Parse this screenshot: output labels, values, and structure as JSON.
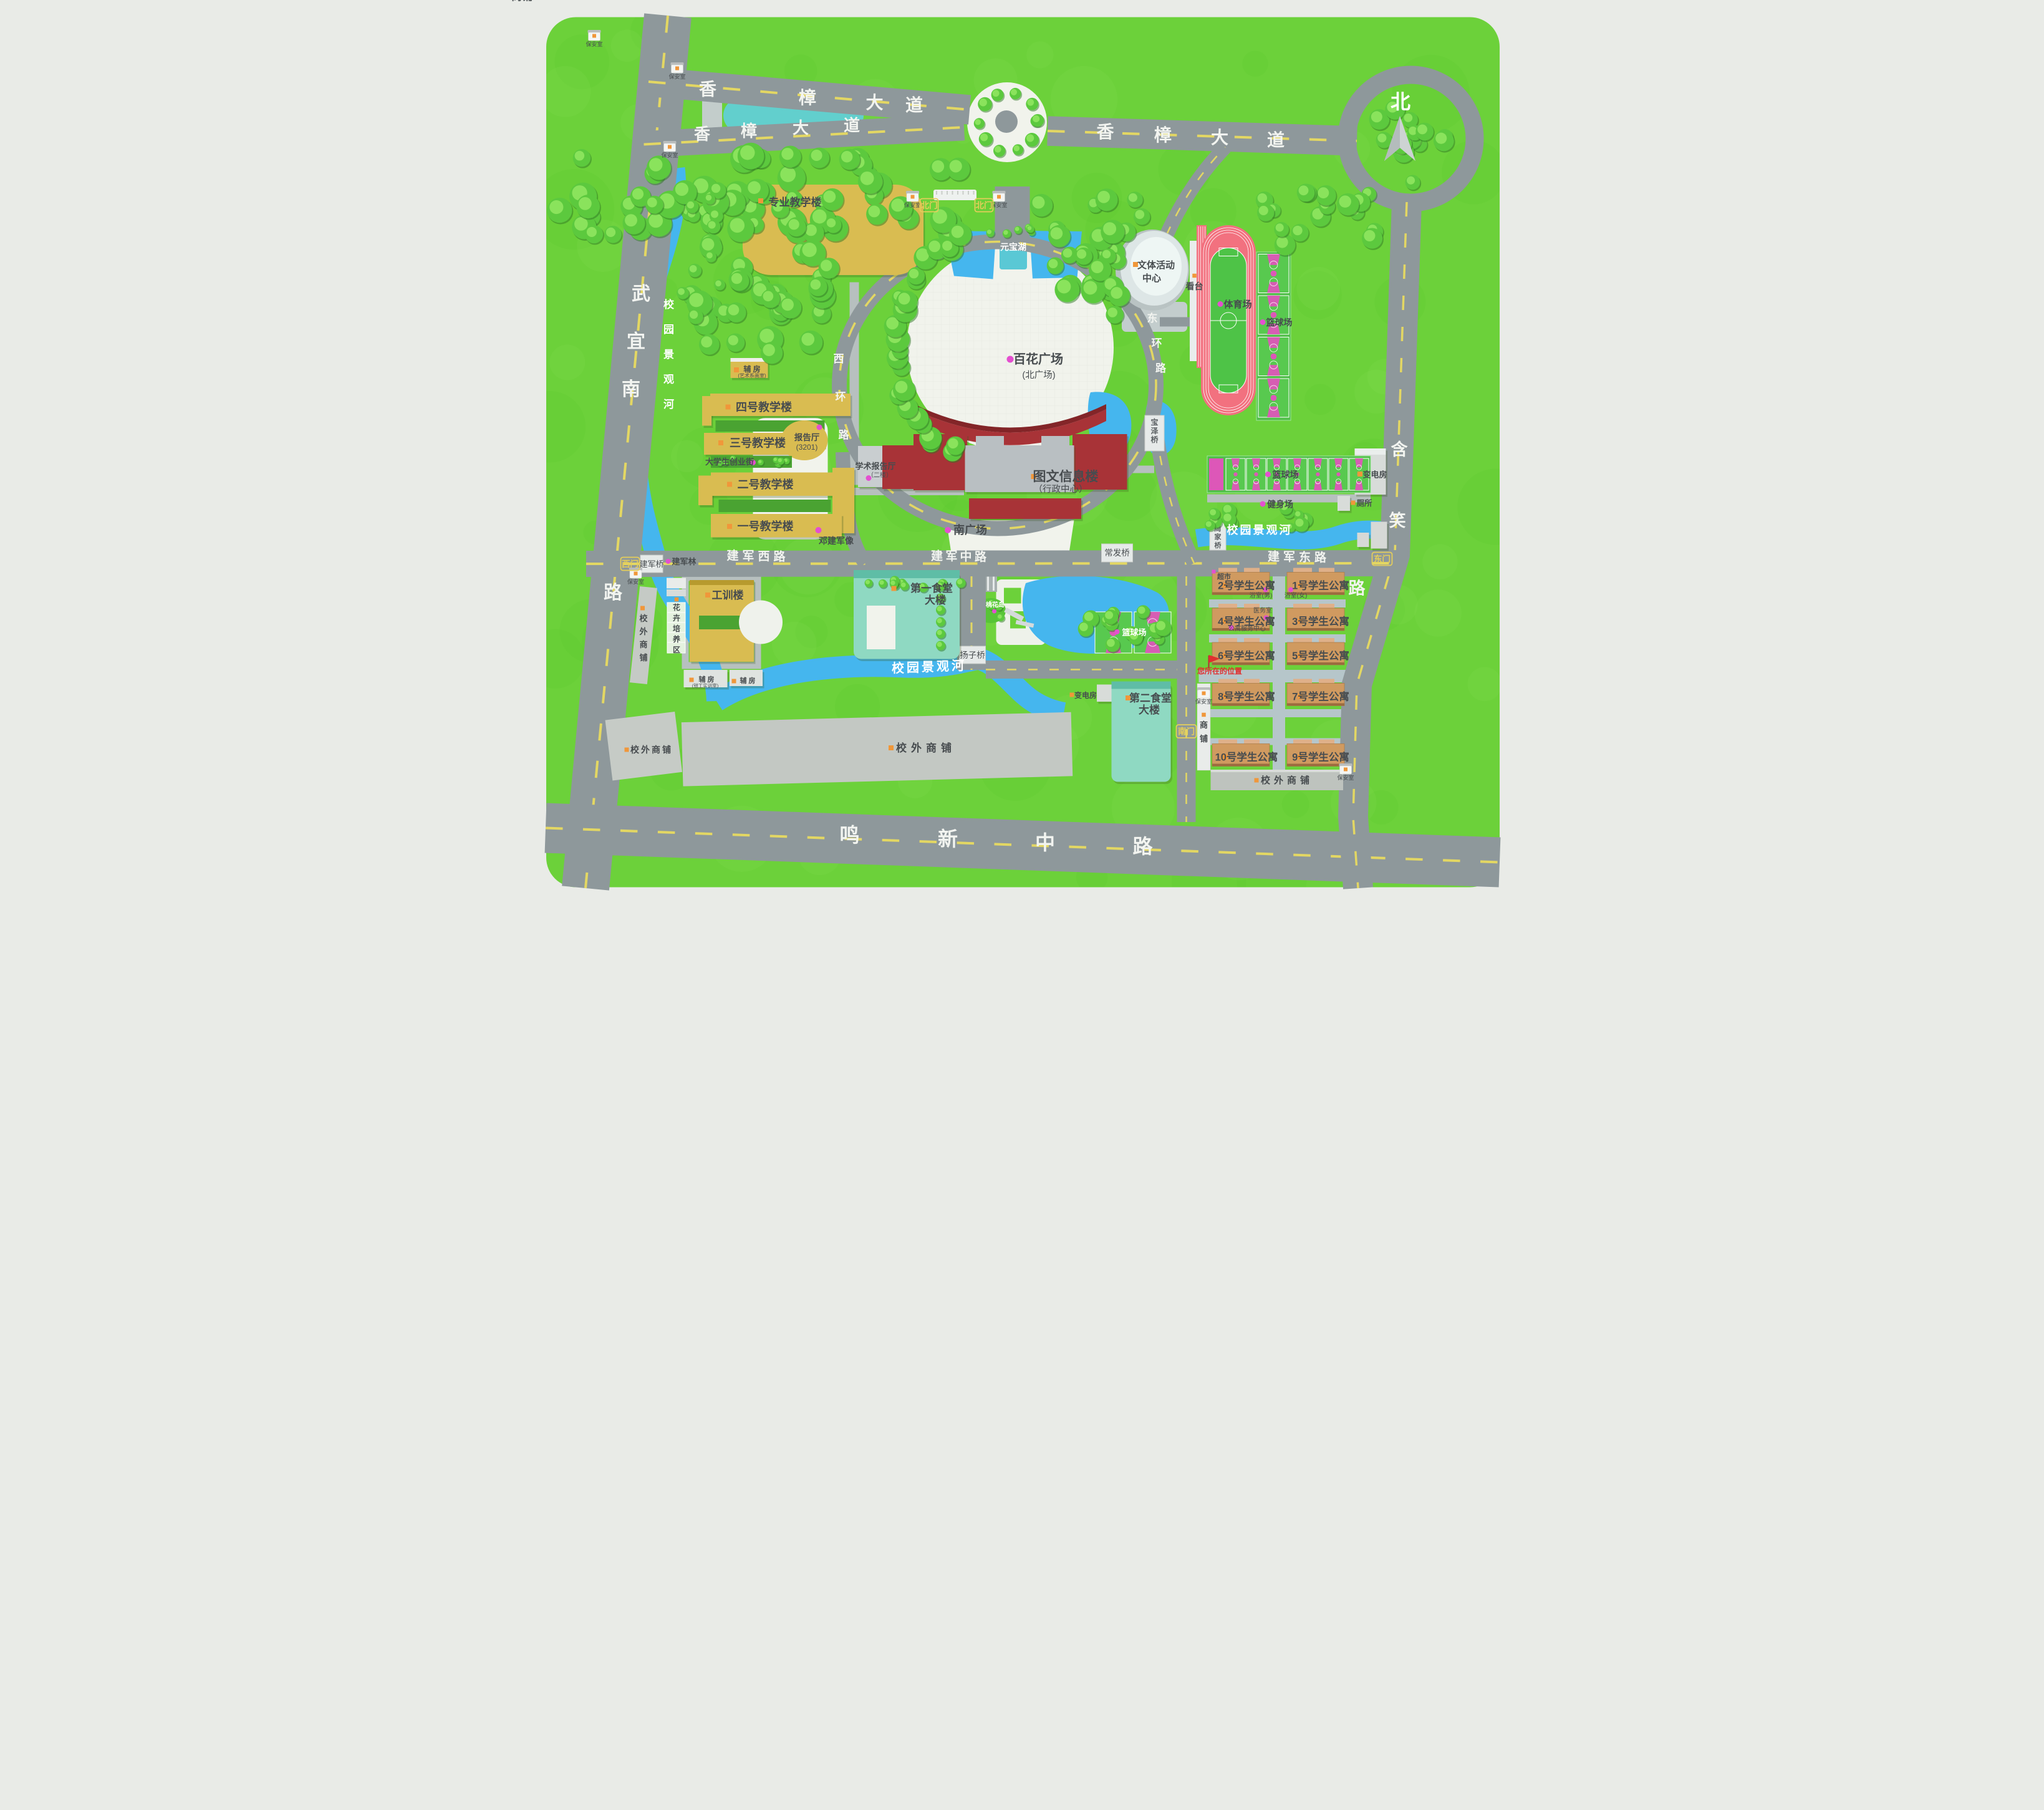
{
  "map": {
    "north_label": "北",
    "roads": {
      "xiangzhang_upper": "香樟大道",
      "xiangzhang_lower": "香樟大道",
      "xiangzhang_right": "香樟大道",
      "wuyi_south": "武宜南路",
      "mingxin": "鸣新中路",
      "hanxiao": "含笑路",
      "jianjun_west": "建军西路",
      "jianjun_middle": "建军中路",
      "jianjun_east": "建军东路",
      "xihuan": "西环路",
      "donghuan": "东环路"
    },
    "gates": {
      "north1": "北门",
      "north2": "北门",
      "west": "西门",
      "east": "东门",
      "south": "南门"
    },
    "bridges": {
      "jianjun": "建军桥",
      "changfa": "常发桥",
      "zhoujia": "周家桥",
      "baoze": "宝泽桥",
      "yangzi": "扬子桥"
    },
    "water": {
      "yuanbao": "元宝湖",
      "river_west": "校园景观河",
      "river_south": "校园景观河",
      "river_east": "校园景观河",
      "taohua_island": "桃花岛"
    },
    "places": {
      "prof_teaching": {
        "label": "专业教学楼"
      },
      "teach4": {
        "label": "四号教学楼"
      },
      "teach3": {
        "label": "三号教学楼"
      },
      "lecture_hall": {
        "label": "报告厅",
        "sub": "(3201)"
      },
      "startup_street": {
        "label": "大学生创业街"
      },
      "teach2": {
        "label": "二号教学楼"
      },
      "teach1": {
        "label": "一号教学楼"
      },
      "fufang_art": {
        "label": "辅 房",
        "sub": "(艺术系画室)"
      },
      "library": {
        "label": "图文信息楼",
        "sub": "（行政中心）"
      },
      "academic_hall": {
        "label": "学术报告厅",
        "sub": "（二楼）"
      },
      "baihua_square": {
        "label": "百花广场",
        "sub": "(北广场)"
      },
      "south_square": {
        "label": "南广场"
      },
      "deng_statue": {
        "label": "邓建军像"
      },
      "jianjun_grove": {
        "label": "建军林"
      },
      "activity_center": {
        "label": "文体活动",
        "label2": "中心"
      },
      "grandstand": {
        "label": "看台"
      },
      "stadium": {
        "label": "体育场"
      },
      "bball_ne": {
        "label": "篮球场"
      },
      "bball_mid": {
        "label": "篮球场"
      },
      "bball_se": {
        "label": "篮球场"
      },
      "fitness": {
        "label": "健身场"
      },
      "substation_ne": {
        "label": "变电房"
      },
      "toilet": {
        "label": "厕所"
      },
      "training_bldg": {
        "label": "工训楼"
      },
      "flower_zone": {
        "label": "花卉培养区"
      },
      "shops_west": {
        "label": "校外商铺"
      },
      "shops_bottom_left": {
        "label": "校外商铺"
      },
      "shops_bottom_center": {
        "label": "校外商铺"
      },
      "shops_se": {
        "label": "校外商铺"
      },
      "fufang_fitter": {
        "label": "辅 房",
        "sub": "(钳工实训室)"
      },
      "fufang2": {
        "label": "辅 房"
      },
      "canteen1": {
        "label": "第一食堂",
        "label2": "大楼"
      },
      "canteen2": {
        "label": "第二食堂",
        "label2": "大楼"
      },
      "substation_s": {
        "label": "变电房"
      },
      "supermarket": {
        "label": "超市"
      },
      "bath_male": {
        "label": "浴室(男)"
      },
      "bath_female": {
        "label": "浴室(女)"
      },
      "clinic": {
        "label": "医务室"
      },
      "apt_service": {
        "label": "公寓服务中心"
      },
      "shop_strip": {
        "label": "商铺"
      },
      "apt1": {
        "label": "1号学生公寓"
      },
      "apt2": {
        "label": "2号学生公寓"
      },
      "apt3": {
        "label": "3号学生公寓"
      },
      "apt4": {
        "label": "4号学生公寓"
      },
      "apt5": {
        "label": "5号学生公寓"
      },
      "apt6": {
        "label": "6号学生公寓"
      },
      "apt7": {
        "label": "7号学生公寓"
      },
      "apt8": {
        "label": "8号学生公寓"
      },
      "apt9": {
        "label": "9号学生公寓"
      },
      "apt10": {
        "label": "10号学生公寓"
      }
    },
    "you_are_here": "您所在的位置",
    "security_room": "保安室",
    "colors": {
      "page_bg": "#e9ebe7",
      "grass": "#6cd13a",
      "road": "#8e989b",
      "road_dash": "#e3d763",
      "road_text": "#f2f4f0",
      "minor_path": "#b7c0bf",
      "plaza": "#f1f3ec",
      "water": "#45b6ee",
      "pond_teal": "#62cfcd",
      "teaching_yellow": "#d9bc51",
      "admin_red": "#a83337",
      "canteen_teal": "#8fd9c2",
      "apartment_tan": "#d09a60",
      "shops_gray": "#c5cac5",
      "track_pink": "#f2717f",
      "field_green": "#4ec347",
      "court_green": "#58c94f",
      "court_pink": "#dd57b8",
      "marker_pink": "#e44fd0",
      "icon_orange": "#f0973a",
      "gate_yellow": "#e5ce5a",
      "label_dark": "#474c4f",
      "alert_red": "#e03030"
    }
  }
}
